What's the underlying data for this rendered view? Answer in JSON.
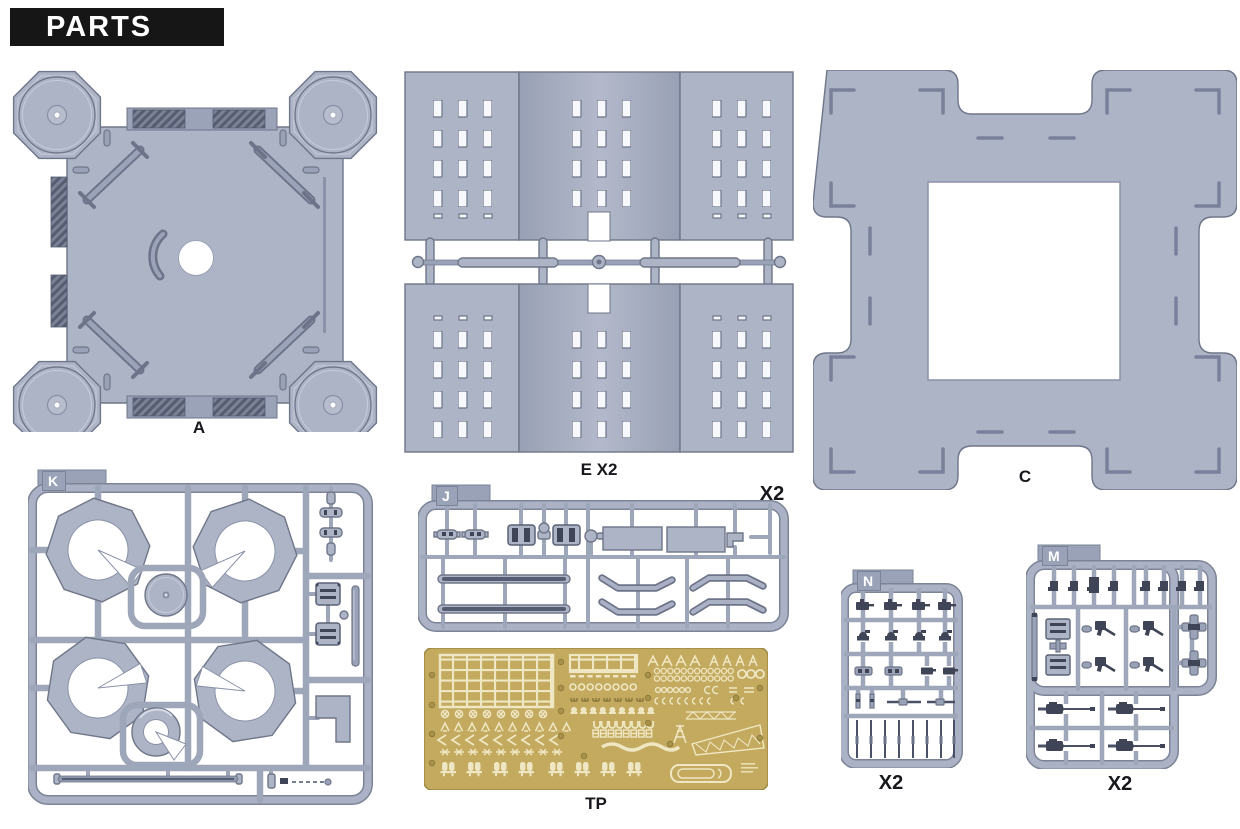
{
  "header": {
    "title": "PARTS"
  },
  "colors": {
    "background": "#ffffff",
    "header_bg": "#161616",
    "header_text": "#ffffff",
    "plastic": "#adb4c6",
    "plastic_mid": "#9aa2b7",
    "plastic_stroke": "#6f7689",
    "detail_dark": "#3f4556",
    "pe_gold": "#c3aa5e",
    "pe_etch": "#efe7c3",
    "label_text": "#17181c"
  },
  "parts": {
    "a": {
      "label": "A"
    },
    "e": {
      "label": "E X2"
    },
    "c": {
      "label": "C"
    },
    "k": {
      "tag": "K"
    },
    "j": {
      "tag": "J",
      "label": "X2"
    },
    "tp": {
      "label": "TP"
    },
    "n": {
      "tag": "N",
      "label": "X2"
    },
    "m": {
      "tag": "M",
      "label": "X2"
    }
  }
}
